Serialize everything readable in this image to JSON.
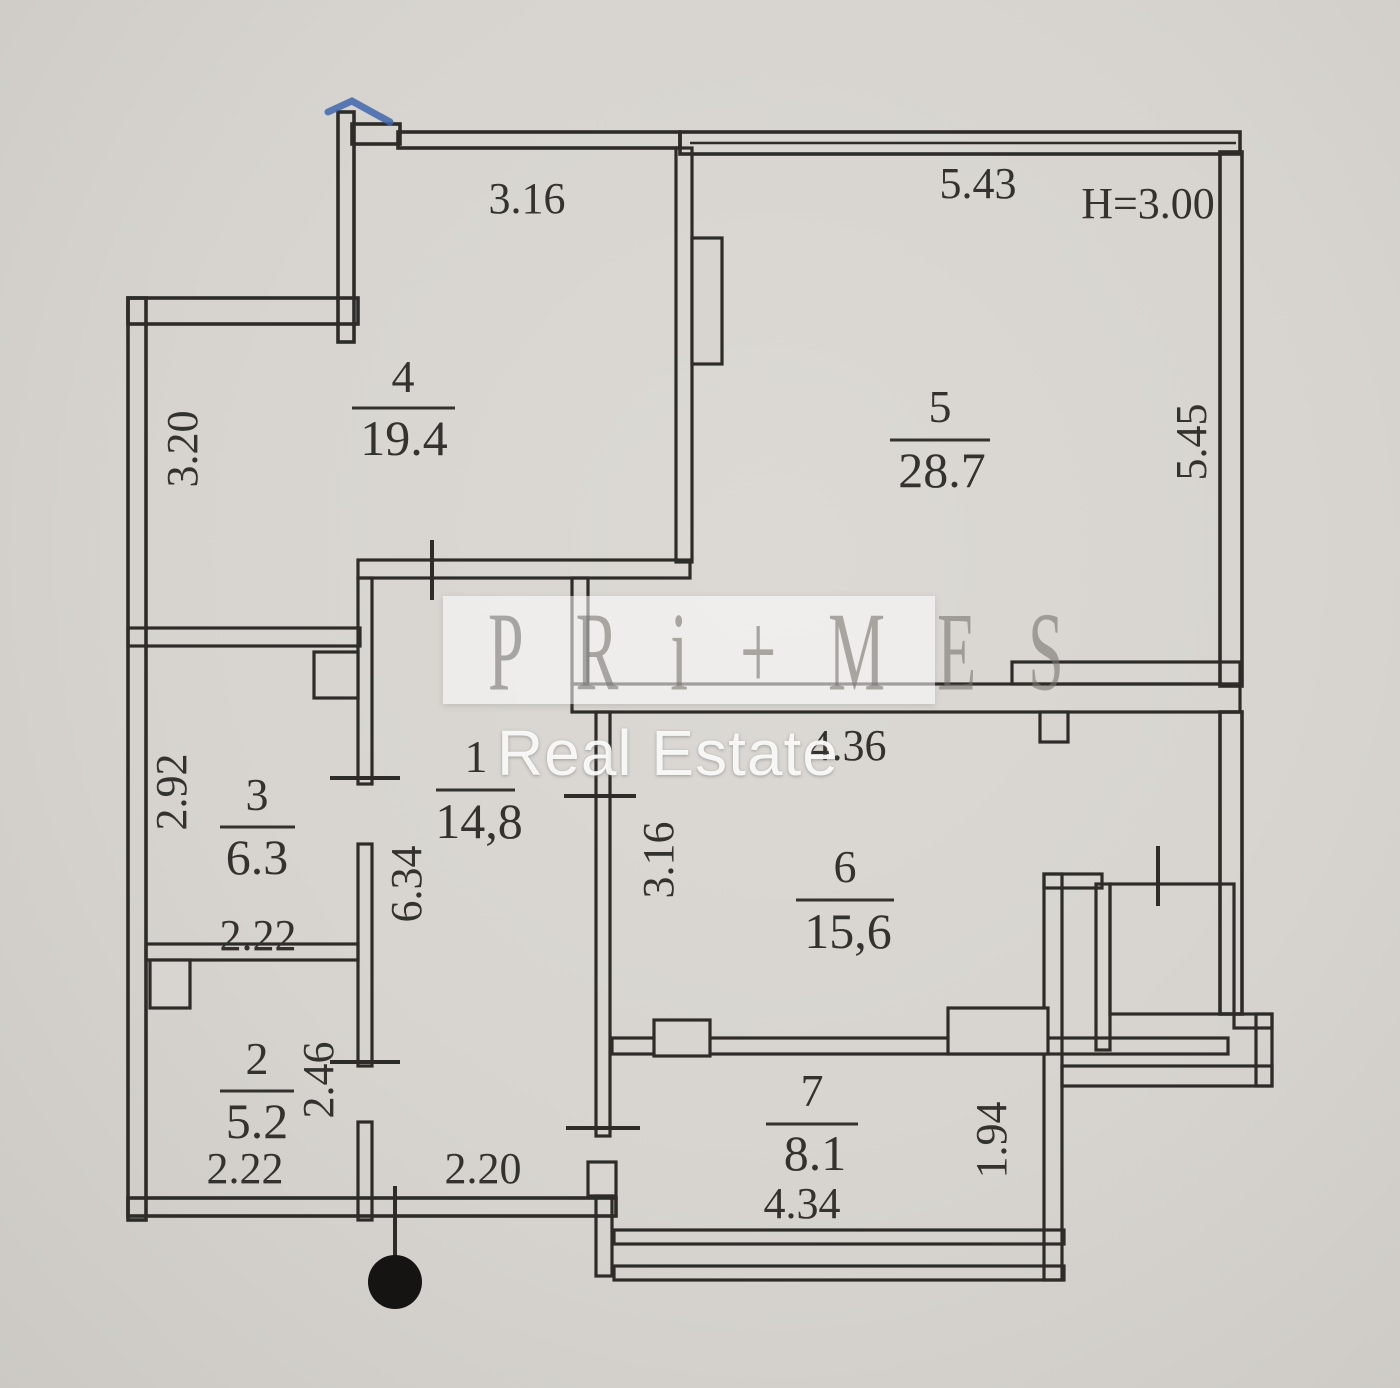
{
  "watermark": {
    "brand": "PRi+MES",
    "subtitle": "Real Estate"
  },
  "plan": {
    "ceiling_height": "H=3.00",
    "rooms": [
      {
        "number": "4",
        "area": "19.4"
      },
      {
        "number": "5",
        "area": "28.7"
      },
      {
        "number": "3",
        "area": "6.3"
      },
      {
        "number": "1",
        "area": "14,8"
      },
      {
        "number": "6",
        "area": "15,6"
      },
      {
        "number": "2",
        "area": "5.2"
      },
      {
        "number": "7",
        "area": "8.1"
      }
    ],
    "dimensions": {
      "top_room4": "3.16",
      "top_room5": "5.43",
      "left_room4": "3.20",
      "right_room5": "5.45",
      "left_room3": "2.92",
      "bottom_room3": "2.22",
      "corridor_height": "6.34",
      "room6_left": "3.16",
      "room6_top": "4.36",
      "room2_right": "2.46",
      "bottom_room2": "2.22",
      "bottom_corridor": "2.20",
      "bottom_room7": "4.34",
      "room7_right": "1.94"
    },
    "colors": {
      "paper": "#d8d5d0",
      "ink": "#2e2c29",
      "pen_mark": "#4066ad"
    }
  }
}
